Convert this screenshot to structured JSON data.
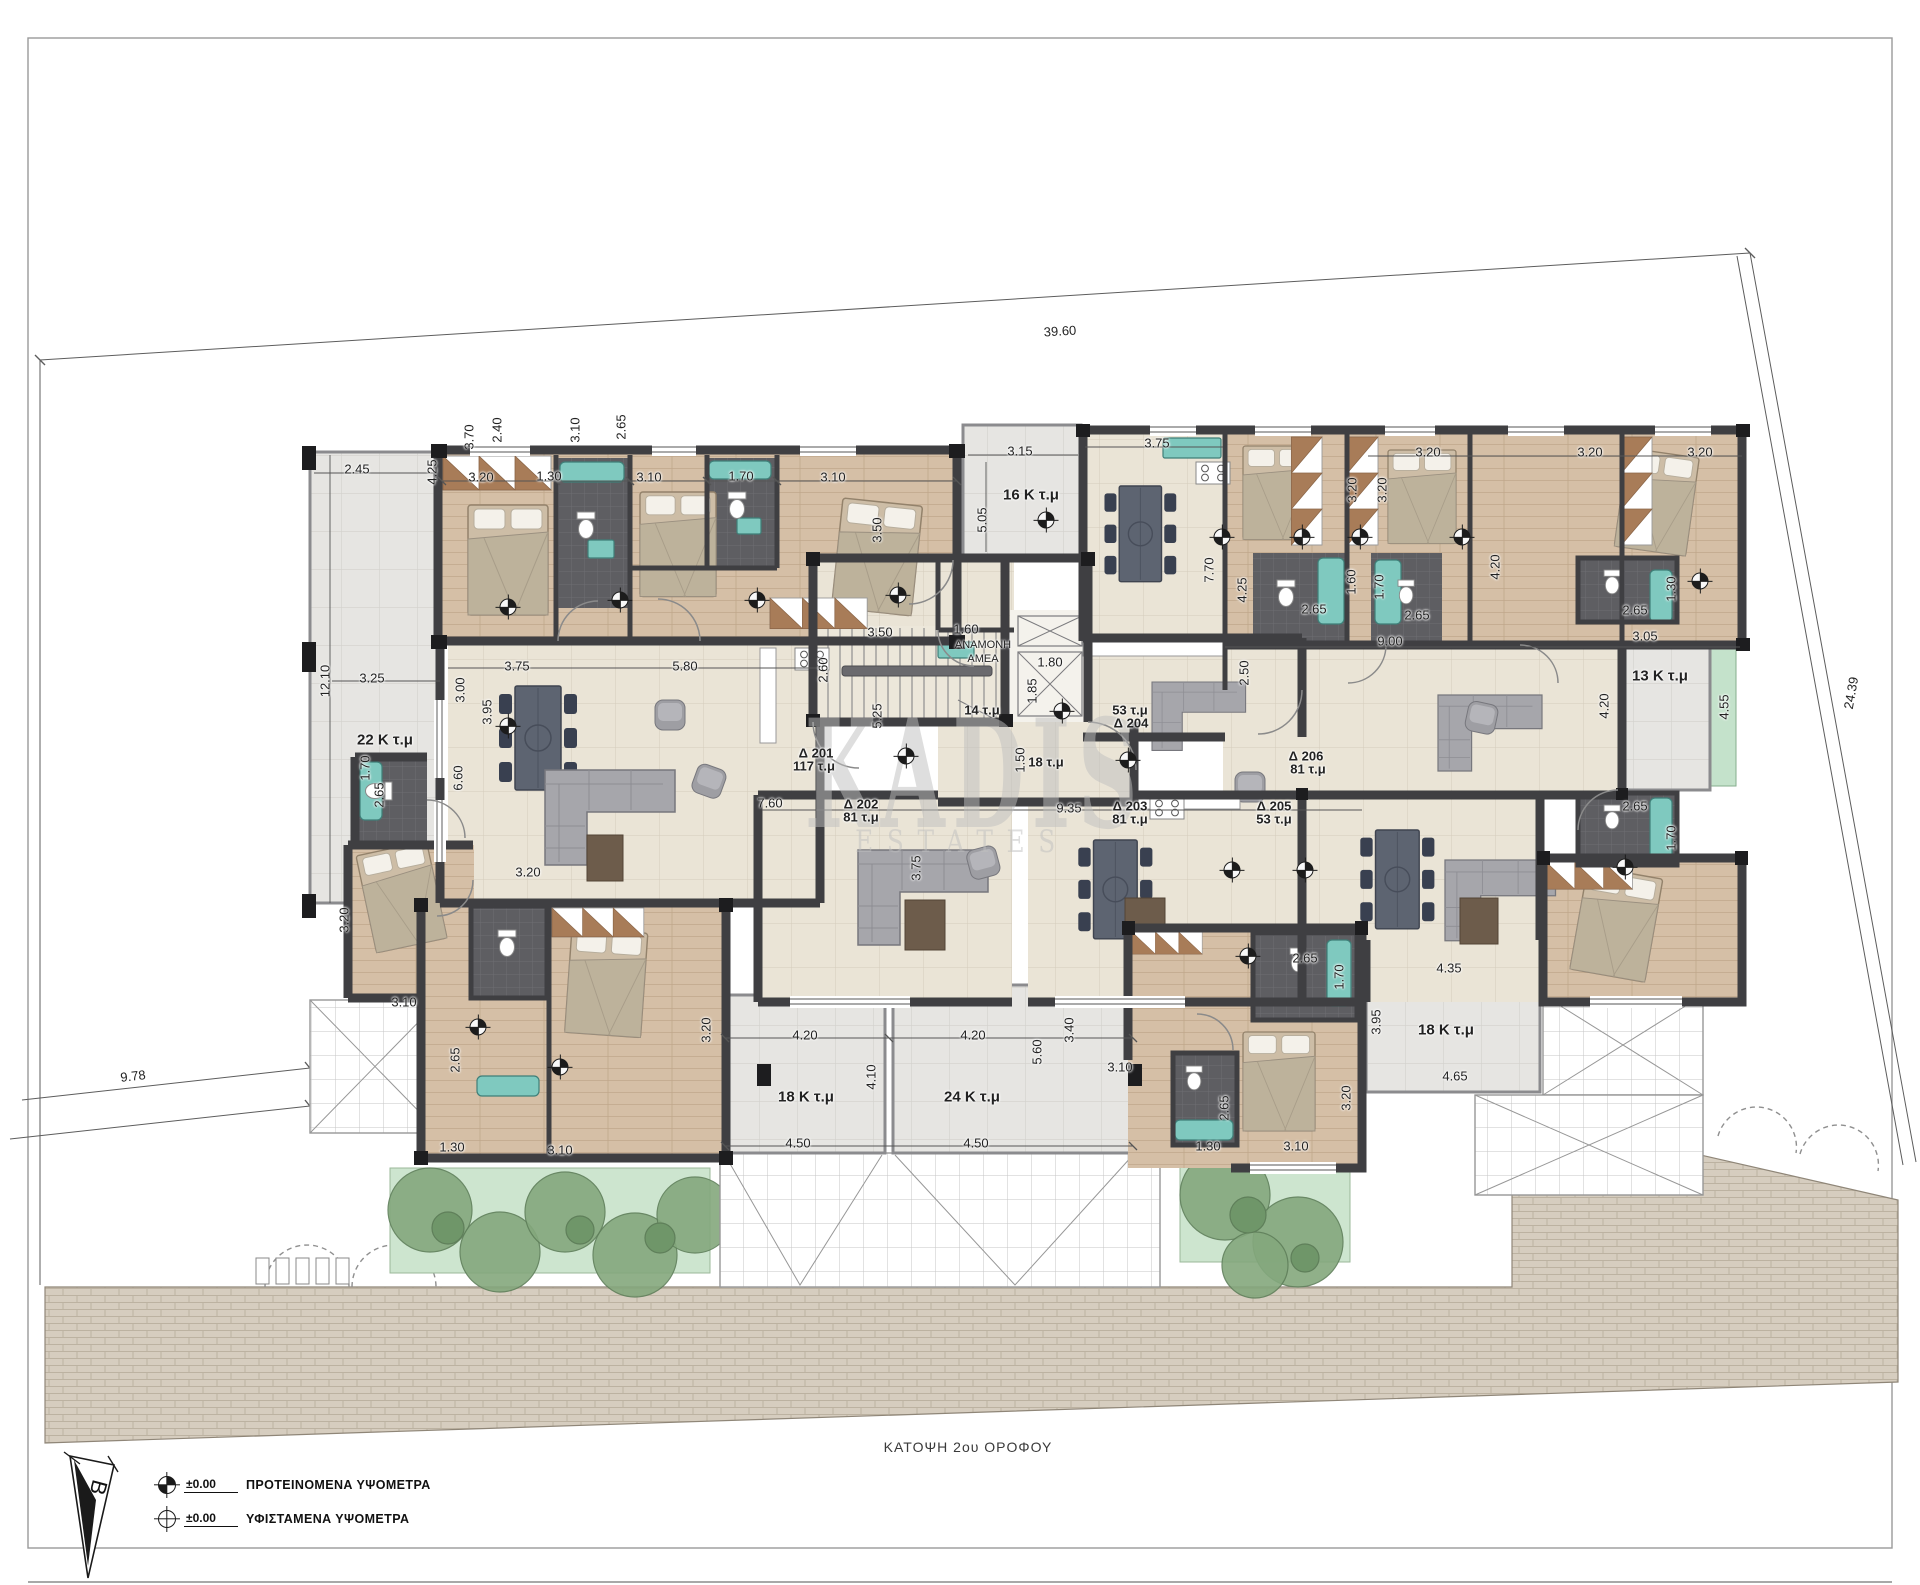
{
  "sheet": {
    "caption": "ΚΑΤΟΨΗ 2ου ΟΡΟΦΟΥ"
  },
  "watermark": {
    "line1": "KADIS",
    "line2": "ESTATES"
  },
  "north": {
    "label": "B"
  },
  "legend": {
    "rows": [
      {
        "symbol": "proposed-elevation-marker",
        "value": "±0.00",
        "label": "ΠΡΟΤΕΙΝΟΜΕΝΑ ΥΨΟΜΕΤΡΑ"
      },
      {
        "symbol": "existing-elevation-marker",
        "value": "±0.00",
        "label": "ΥΦΙΣΤΑΜΕΝΑ ΥΨΟΜΕΤΡΑ"
      }
    ]
  },
  "apartments": [
    {
      "id": "Δ 201",
      "area": "117 τ.μ"
    },
    {
      "id": "Δ 202",
      "area": "81 τ.μ"
    },
    {
      "id": "Δ 203",
      "area": "81 τ.μ"
    },
    {
      "id": "Δ 204",
      "area": "53 τ.μ"
    },
    {
      "id": "Δ 205",
      "area": "53 τ.μ"
    },
    {
      "id": "Δ 206",
      "area": "81 τ.μ"
    }
  ],
  "lift_lobby": {
    "waiting": "ΑΝΑΜΟΝΗ",
    "amea": "ΑΜΕΑ",
    "lobby_area": "14 τ.μ",
    "hall_area": "18 τ.μ"
  },
  "labels": [
    [
      "39.60",
      1060,
      331,
      -3.5,
      "d"
    ],
    [
      "24.39",
      1851,
      693,
      -80,
      "d"
    ],
    [
      "9.78",
      133,
      1076,
      -6.5,
      "d"
    ],
    [
      "2.45",
      357,
      469,
      0,
      "d"
    ],
    [
      "12.10",
      325,
      681,
      -90,
      "d"
    ],
    [
      "3.25",
      372,
      678,
      0,
      "d"
    ],
    [
      "22 Κ τ.μ",
      385,
      740,
      0,
      "r"
    ],
    [
      "3.75",
      517,
      666,
      0,
      "d"
    ],
    [
      "3.00",
      460,
      690,
      -90,
      "d"
    ],
    [
      "6.60",
      458,
      778,
      -90,
      "d"
    ],
    [
      "3.95",
      487,
      712,
      -90,
      "d"
    ],
    [
      "5.80",
      685,
      666,
      0,
      "d"
    ],
    [
      "3.20",
      481,
      477,
      0,
      "d"
    ],
    [
      "1.30",
      549,
      476,
      0,
      "d"
    ],
    [
      "3.10",
      649,
      477,
      0,
      "d"
    ],
    [
      "1.70",
      741,
      476,
      0,
      "d"
    ],
    [
      "3.10",
      833,
      477,
      0,
      "d"
    ],
    [
      "4.25",
      432,
      472,
      -90,
      "d"
    ],
    [
      "3.70",
      469,
      437,
      -90,
      "d"
    ],
    [
      "2.40",
      497,
      430,
      -90,
      "d"
    ],
    [
      "3.10",
      575,
      430,
      -90,
      "d"
    ],
    [
      "2.65",
      621,
      427,
      -90,
      "d"
    ],
    [
      "3.50",
      877,
      530,
      -90,
      "d"
    ],
    [
      "3.50",
      880,
      632,
      0,
      "d"
    ],
    [
      "2.60",
      823,
      670,
      -90,
      "d"
    ],
    [
      "1.60",
      966,
      629,
      0,
      "d"
    ],
    [
      "ΑΝΑΜΟΝΗ",
      983,
      645,
      0,
      "n"
    ],
    [
      "ΑΜΕΑ",
      983,
      659,
      0,
      "n"
    ],
    [
      "1.80",
      1050,
      662,
      0,
      "d"
    ],
    [
      "1.85",
      1032,
      691,
      -90,
      "d"
    ],
    [
      "14 τ.μ",
      982,
      710,
      0,
      "a"
    ],
    [
      "1.50",
      1020,
      760,
      -90,
      "d"
    ],
    [
      "18 τ.μ",
      1046,
      762,
      0,
      "a"
    ],
    [
      "Δ 201",
      816,
      753,
      0,
      "a"
    ],
    [
      "117 τ.μ",
      814,
      766,
      0,
      "a"
    ],
    [
      "Δ 202",
      861,
      804,
      0,
      "a"
    ],
    [
      "81 τ.μ",
      861,
      817,
      0,
      "a"
    ],
    [
      "7.60",
      770,
      803,
      0,
      "d"
    ],
    [
      "9.35",
      1069,
      808,
      0,
      "d"
    ],
    [
      "Δ 203",
      1130,
      806,
      0,
      "a"
    ],
    [
      "81 τ.μ",
      1130,
      819,
      0,
      "a"
    ],
    [
      "53 τ.μ",
      1130,
      710,
      0,
      "a"
    ],
    [
      "Δ 204",
      1131,
      723,
      0,
      "a"
    ],
    [
      "Δ 205",
      1274,
      806,
      0,
      "a"
    ],
    [
      "53 τ.μ",
      1274,
      819,
      0,
      "a"
    ],
    [
      "Δ 206",
      1306,
      756,
      0,
      "a"
    ],
    [
      "81 τ.μ",
      1308,
      769,
      0,
      "a"
    ],
    [
      "3.75",
      916,
      868,
      -90,
      "d"
    ],
    [
      "5.25",
      877,
      716,
      -90,
      "d"
    ],
    [
      "3.15",
      1020,
      451,
      0,
      "d"
    ],
    [
      "16 Κ τ.μ",
      1031,
      495,
      0,
      "r"
    ],
    [
      "5.05",
      982,
      520,
      -90,
      "d"
    ],
    [
      "3.75",
      1157,
      443,
      0,
      "d"
    ],
    [
      "3.20",
      1428,
      452,
      0,
      "d"
    ],
    [
      "3.20",
      1590,
      452,
      0,
      "d"
    ],
    [
      "3.20",
      1700,
      452,
      0,
      "d"
    ],
    [
      "3.20",
      1352,
      490,
      -90,
      "d"
    ],
    [
      "3.20",
      1382,
      490,
      -90,
      "d"
    ],
    [
      "7.70",
      1209,
      570,
      -90,
      "d"
    ],
    [
      "4.25",
      1242,
      590,
      -90,
      "d"
    ],
    [
      "4.20",
      1495,
      567,
      -90,
      "d"
    ],
    [
      "2.50",
      1244,
      673,
      -90,
      "d"
    ],
    [
      "1.60",
      1351,
      582,
      -90,
      "d"
    ],
    [
      "1.70",
      1379,
      587,
      -90,
      "d"
    ],
    [
      "2.65",
      1314,
      609,
      0,
      "d"
    ],
    [
      "2.65",
      1417,
      615,
      0,
      "d"
    ],
    [
      "9.00",
      1390,
      641,
      0,
      "d"
    ],
    [
      "2.65",
      1635,
      610,
      0,
      "d"
    ],
    [
      "1.30",
      1671,
      589,
      -90,
      "d"
    ],
    [
      "3.05",
      1645,
      636,
      0,
      "d"
    ],
    [
      "13 Κ τ.μ",
      1660,
      676,
      0,
      "r"
    ],
    [
      "4.20",
      1604,
      706,
      -90,
      "d"
    ],
    [
      "4.55",
      1724,
      707,
      -90,
      "d"
    ],
    [
      "2.65",
      1635,
      806,
      0,
      "d"
    ],
    [
      "1.70",
      1671,
      838,
      -90,
      "d"
    ],
    [
      "2.65",
      1305,
      958,
      0,
      "d"
    ],
    [
      "1.70",
      1339,
      977,
      -90,
      "d"
    ],
    [
      "4.35",
      1449,
      968,
      0,
      "d"
    ],
    [
      "3.95",
      1376,
      1022,
      -90,
      "d"
    ],
    [
      "18 Κ τ.μ",
      1446,
      1030,
      0,
      "r"
    ],
    [
      "4.65",
      1455,
      1076,
      0,
      "d"
    ],
    [
      "2.65",
      1224,
      1108,
      -90,
      "d"
    ],
    [
      "1.30",
      1208,
      1146,
      0,
      "d"
    ],
    [
      "3.10",
      1296,
      1146,
      0,
      "d"
    ],
    [
      "3.20",
      1346,
      1098,
      -90,
      "d"
    ],
    [
      "3.40",
      1069,
      1030,
      -90,
      "d"
    ],
    [
      "3.10",
      1120,
      1067,
      0,
      "d"
    ],
    [
      "3.20",
      706,
      1030,
      -90,
      "d"
    ],
    [
      "4.20",
      805,
      1035,
      0,
      "d"
    ],
    [
      "4.20",
      973,
      1035,
      0,
      "d"
    ],
    [
      "4.10",
      871,
      1077,
      -90,
      "d"
    ],
    [
      "5.60",
      1037,
      1052,
      -90,
      "d"
    ],
    [
      "18 Κ τ.μ",
      806,
      1097,
      0,
      "r"
    ],
    [
      "24 Κ τ.μ",
      972,
      1097,
      0,
      "r"
    ],
    [
      "4.50",
      798,
      1143,
      0,
      "d"
    ],
    [
      "4.50",
      976,
      1143,
      0,
      "d"
    ],
    [
      "1.70",
      365,
      768,
      -90,
      "d"
    ],
    [
      "2.65",
      379,
      795,
      -90,
      "d"
    ],
    [
      "3.20",
      344,
      920,
      -90,
      "d"
    ],
    [
      "3.10",
      404,
      1002,
      0,
      "d"
    ],
    [
      "2.65",
      455,
      1060,
      -90,
      "d"
    ],
    [
      "1.30",
      452,
      1147,
      0,
      "d"
    ],
    [
      "3.10",
      560,
      1150,
      0,
      "d"
    ],
    [
      "3.20",
      528,
      872,
      0,
      "d"
    ]
  ],
  "markers": [
    [
      508,
      607
    ],
    [
      620,
      600
    ],
    [
      757,
      600
    ],
    [
      508,
      726
    ],
    [
      898,
      595
    ],
    [
      1046,
      520
    ],
    [
      1222,
      537
    ],
    [
      1302,
      537
    ],
    [
      1360,
      537
    ],
    [
      1462,
      537
    ],
    [
      1700,
      581
    ],
    [
      906,
      756
    ],
    [
      1062,
      711
    ],
    [
      1128,
      760
    ],
    [
      1232,
      870
    ],
    [
      1305,
      870
    ],
    [
      1625,
      867
    ],
    [
      478,
      1027
    ],
    [
      560,
      1067
    ],
    [
      1248,
      956
    ]
  ],
  "colors": {
    "wall": "#3f3f42",
    "tile": "#eae4d6",
    "wood": "#d5bfa6",
    "bath": "#5e5e62",
    "balcony": "#e6e5e2",
    "teal": "#7fc9bf",
    "planter": "#cde5cf",
    "plant": "#84a87d",
    "road": "#d6cdbf",
    "wardrobe": "#a87c58",
    "dimtext": "#222222",
    "wm": "#bfbfbf"
  }
}
